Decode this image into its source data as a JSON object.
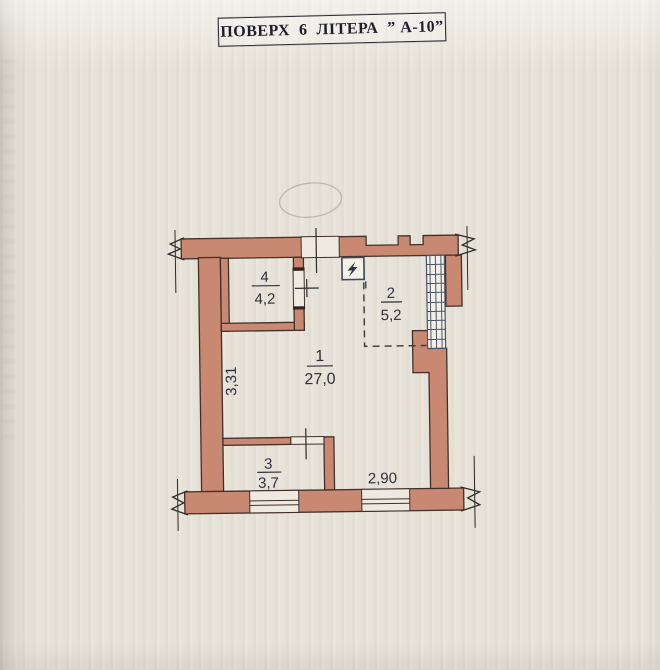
{
  "page": {
    "title": "ПОВЕРХ  6  ЛІТЕРА  ” А-10”"
  },
  "plan": {
    "rooms": [
      {
        "number": "1",
        "area": "27,0"
      },
      {
        "number": "2",
        "area": "5,2"
      },
      {
        "number": "3",
        "area": "3,7"
      },
      {
        "number": "4",
        "area": "4,2"
      }
    ],
    "dimensions": {
      "left_wall": "3,31",
      "bottom_window": "2,90"
    },
    "symbols": {
      "electrical_panel": "lightning-bolt-in-square"
    },
    "colors": {
      "paper": "#e9e4da",
      "wall_fill": "#c98871",
      "wall_outline": "#41302a",
      "glazing_stroke": "#4a5668",
      "ink": "#2f2f38"
    }
  }
}
